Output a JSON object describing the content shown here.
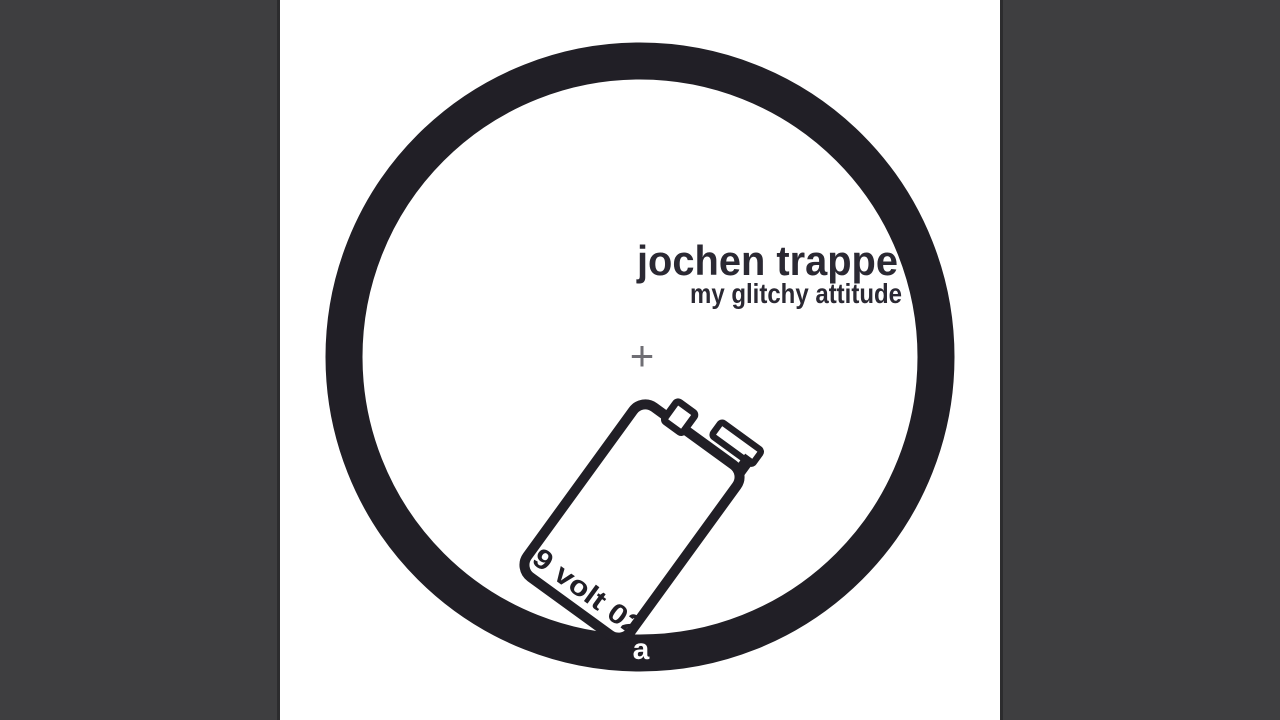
{
  "artwork": {
    "artist": "jochen trappe",
    "title": "my glitchy attitude",
    "catalog": "9 volt 02",
    "side": "a",
    "center_mark": "+"
  },
  "colors": {
    "pillarbox_gray": "#3e3e40",
    "pillarbox_edge": "#2c2c2e",
    "ink_black": "#211f26",
    "text_black": "#2b2933",
    "center_mark_gray": "#6f6e74",
    "background_white": "#ffffff"
  },
  "icons": {
    "record_label_ring": "thick-black-circle-outline",
    "battery": "tilted-9-volt-battery-outline",
    "center_mark": "small-gray-plus-registration-cross"
  }
}
